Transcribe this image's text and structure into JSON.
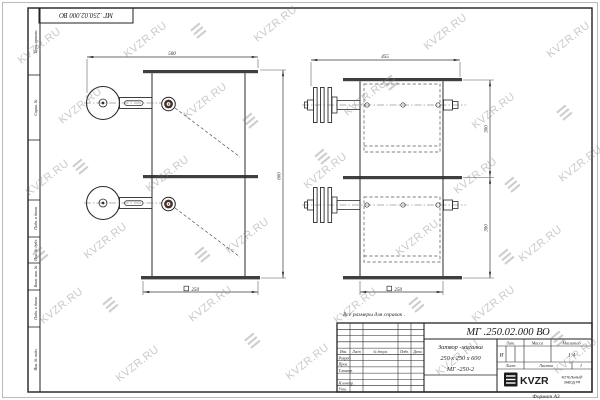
{
  "stamp_top": "МГ .250.02.000 ВО",
  "note": "Все размеры для справок .",
  "watermark": {
    "text": "KVZR.RU",
    "logo_glyph": "☰"
  },
  "frame": {
    "left_labels": [
      "Перв. примен.",
      "Справ. №",
      "Подп. и дата",
      "Инв. № дубл.",
      "Взам. инв. №",
      "Подп. и дата",
      "Инв. № подл."
    ]
  },
  "views": {
    "front": {
      "width_top": "500",
      "height": "600",
      "width_bottom": "250"
    },
    "side": {
      "width_top": "455",
      "height_top": "300",
      "height_bottom": "300",
      "width_bottom": "250"
    }
  },
  "title_block": {
    "doc_number": "МГ .250.02.000 ВО",
    "name_line1": "Затвор -мигалка",
    "name_line2": "250 х 250 х 600",
    "name_line3": "МГ -250-2",
    "headers": {
      "lit": "Лит.",
      "mass": "Масса",
      "scale": "Масштаб"
    },
    "values": {
      "lit": "И",
      "scale": "1:4"
    },
    "sheet_label": "Лист",
    "sheets_label": "Листов",
    "sheets_value": "1",
    "sig_header": [
      "Изм.",
      "Лист",
      "№ докум.",
      "Подп.",
      "Дата"
    ],
    "sig_rows": [
      "Разраб.",
      "Пров.",
      "Т.контр.",
      "Н.контр.",
      "Утв."
    ],
    "logo_text": "KVZR",
    "logo_sub1": "КОТЕЛЬНЫЙ",
    "logo_sub2": "ЗАВОД РФ",
    "format": "Формат А3"
  }
}
